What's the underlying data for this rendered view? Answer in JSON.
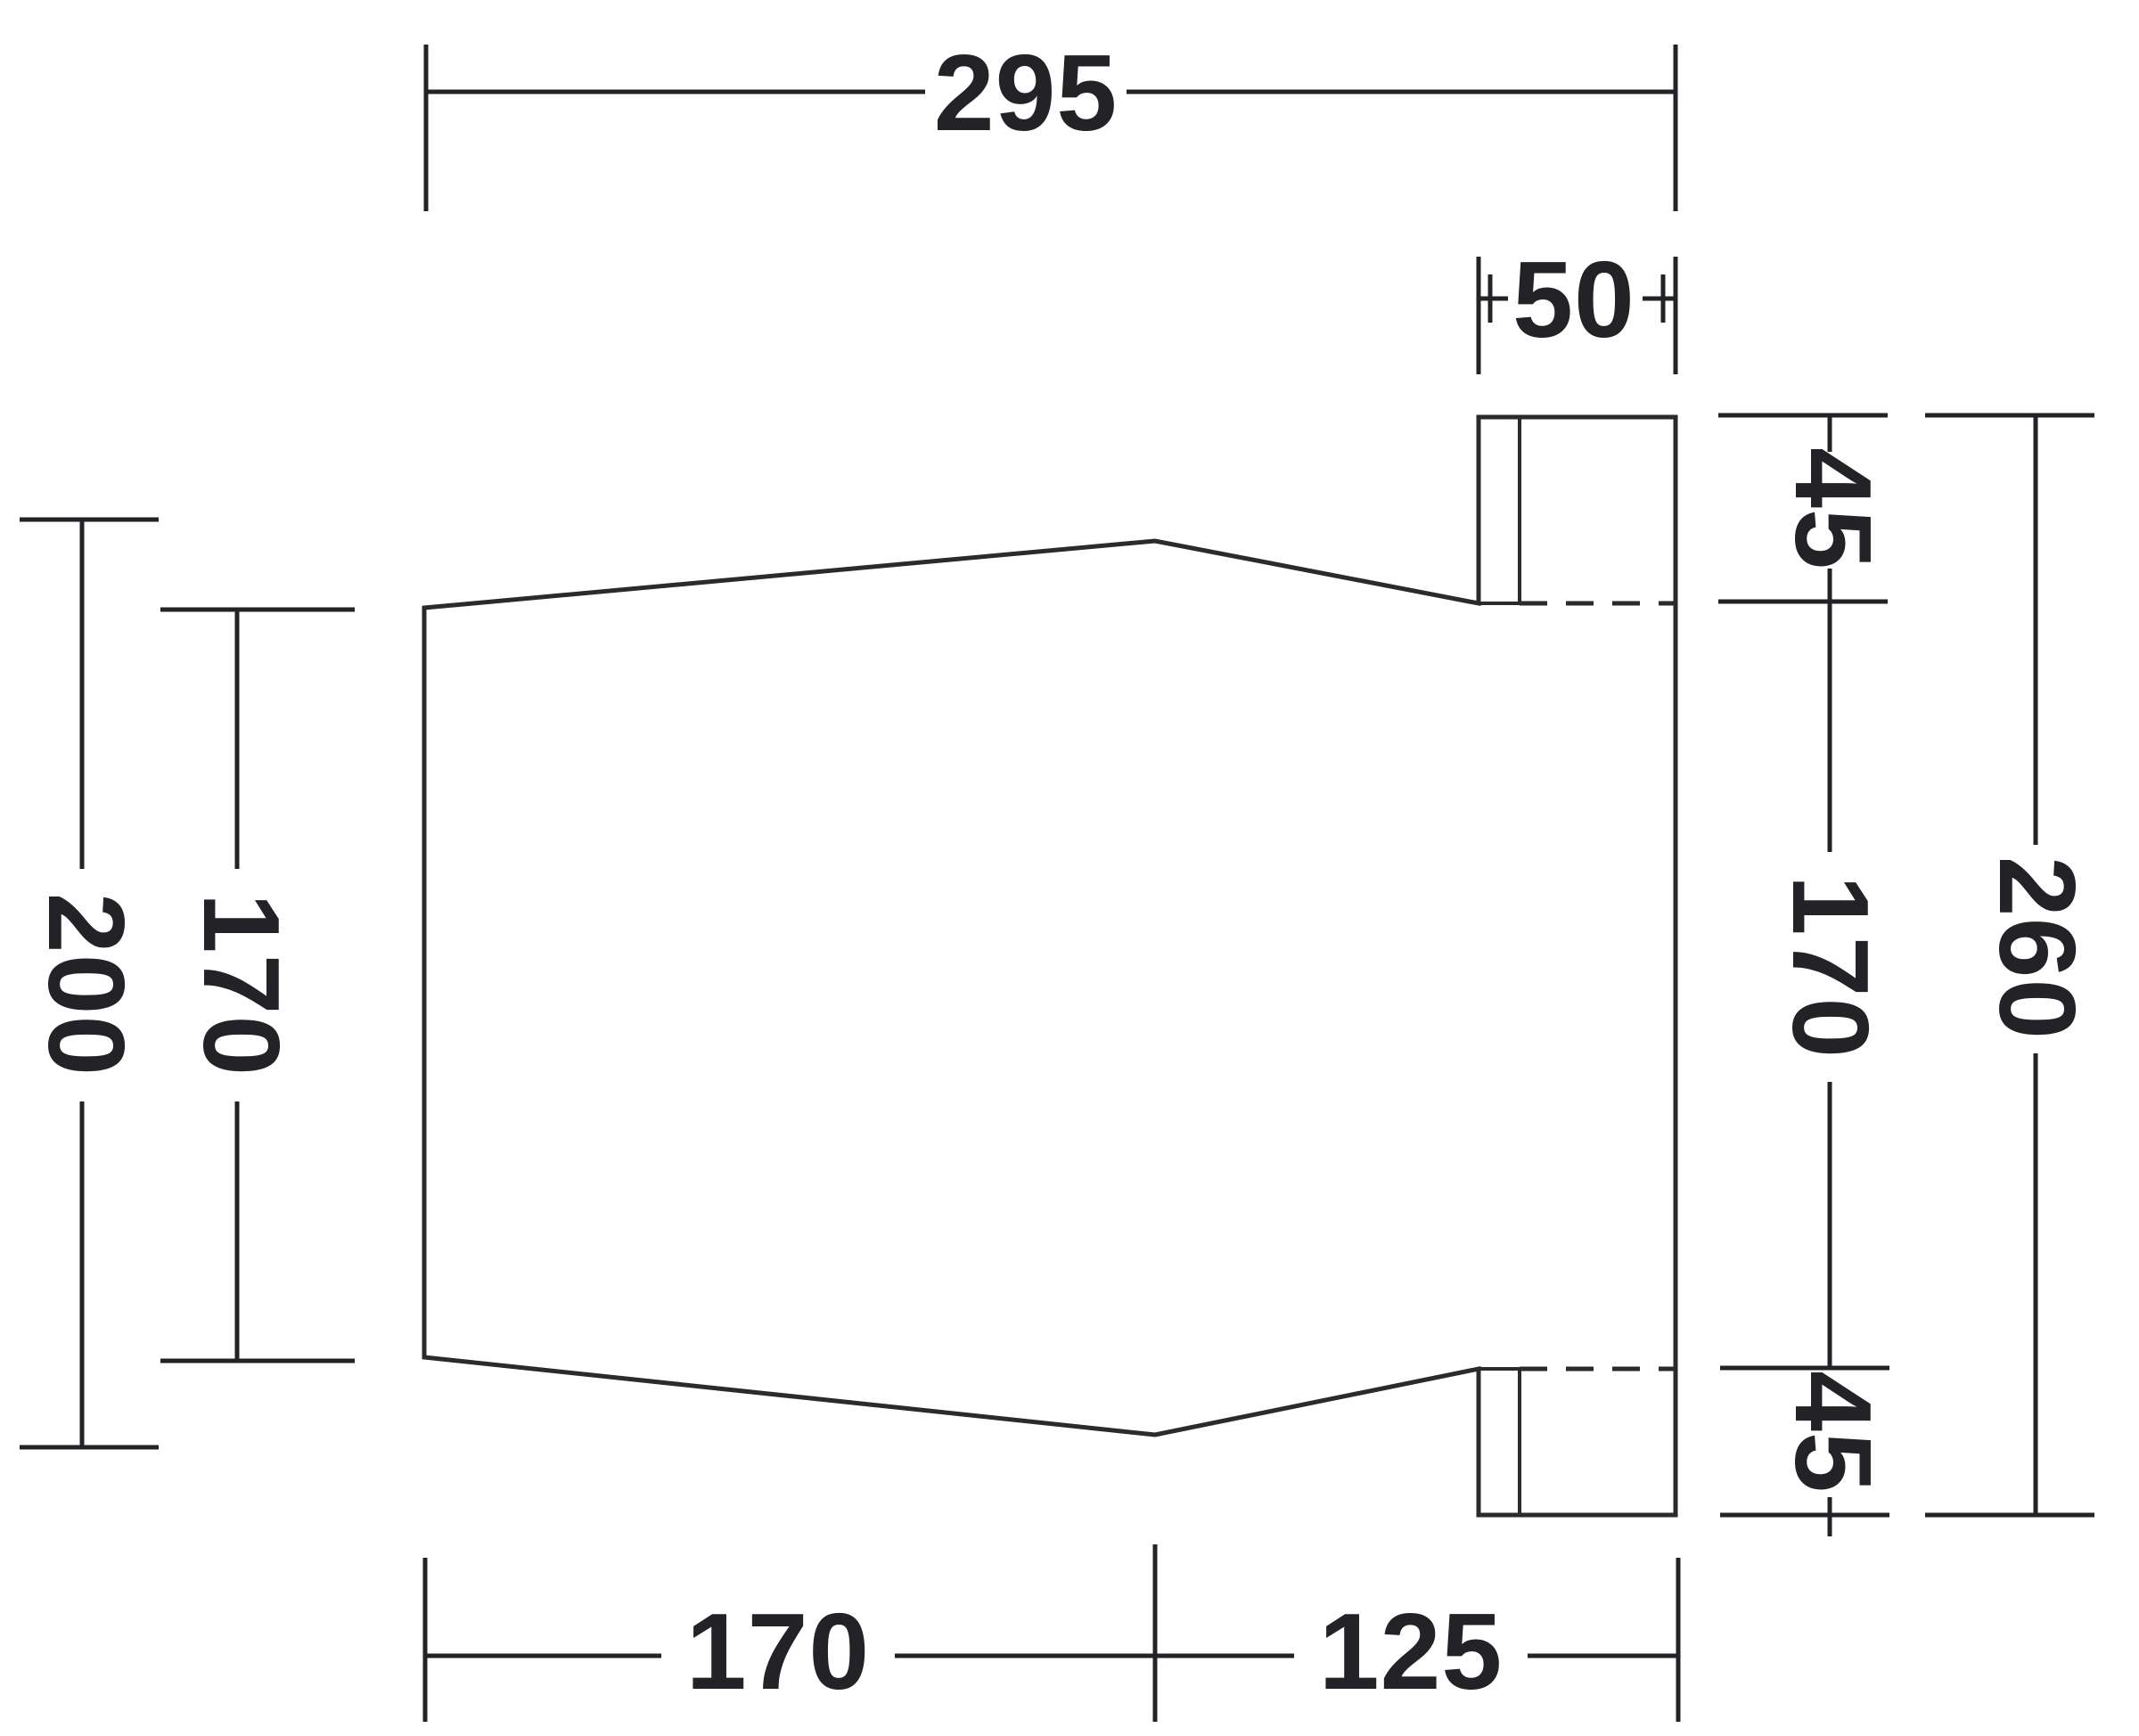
{
  "diagram": {
    "type": "technical-dimension-drawing",
    "view": "plan-footprint-with-right-sleeve",
    "colors": {
      "background": "#ffffff",
      "shape_fill": "#6c6d72",
      "outline": "#2b2b2e",
      "dimension_lines": "#232226",
      "dimension_text": "#232226"
    },
    "labels": {
      "top_width": "295",
      "sleeve_width": "50",
      "right_top_flange": "45",
      "right_side": "170",
      "right_bottom_flange": "45",
      "right_total": "260",
      "left_total": "200",
      "left_side": "170",
      "bottom_left": "170",
      "bottom_right": "125"
    }
  }
}
